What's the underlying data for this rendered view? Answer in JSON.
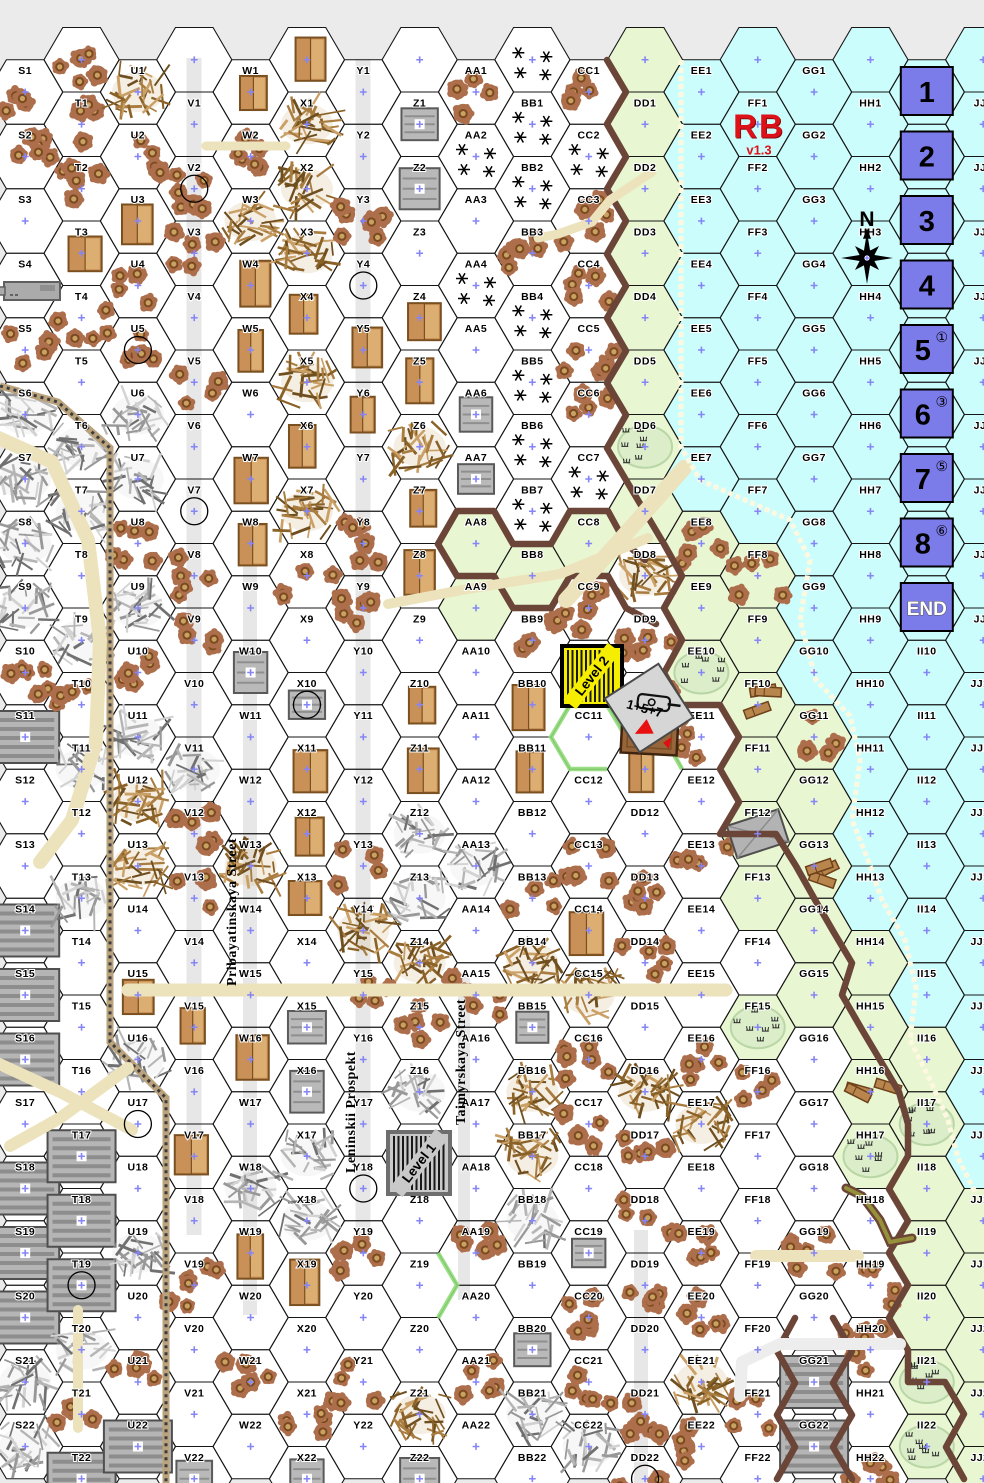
{
  "title": "RB v1.3 hex wargame map",
  "logo": {
    "line1": "RB",
    "line2": "v1.3",
    "color": "#dd1118",
    "x": 759,
    "y": 133
  },
  "compass": {
    "label": "N",
    "x": 867,
    "y": 258
  },
  "street_names": [
    {
      "text": "Pribayatinskaya Street",
      "x": 233,
      "y": 912
    },
    {
      "text": "Leninskii Prospekt",
      "x": 352,
      "y": 1112
    },
    {
      "text": "Taimyrskaya Street",
      "x": 462,
      "y": 1062
    }
  ],
  "turn_track": {
    "box_color": "#7b7bea",
    "box_border": "#000000",
    "column": "II",
    "boxes": [
      {
        "hex": "II1",
        "label": "1",
        "superscript": ""
      },
      {
        "hex": "II2",
        "label": "2",
        "superscript": ""
      },
      {
        "hex": "II3",
        "label": "3",
        "superscript": ""
      },
      {
        "hex": "II4",
        "label": "4",
        "superscript": ""
      },
      {
        "hex": "II5",
        "label": "5",
        "superscript": "①"
      },
      {
        "hex": "II6",
        "label": "6",
        "superscript": "③"
      },
      {
        "hex": "II7",
        "label": "7",
        "superscript": "⑤"
      },
      {
        "hex": "II8",
        "label": "8",
        "superscript": "⑥"
      },
      {
        "hex": "II9",
        "label": "END",
        "superscript": ""
      }
    ]
  },
  "counters": [
    {
      "id": "level2-counter",
      "label": "Level 2",
      "type": "level",
      "bg": "#f6ee00",
      "border": "#000000",
      "x": 592,
      "y": 676,
      "size": 60,
      "rot": 0,
      "text_rot": -52
    },
    {
      "id": "level1-counter",
      "label": "Level 1",
      "type": "level",
      "bg": "#c9c9c9",
      "border": "#6e6e6e",
      "x": 419,
      "y": 1163,
      "size": 62,
      "rot": 0,
      "text_rot": -52
    },
    {
      "id": "wreck-counter",
      "label": "",
      "type": "wreck",
      "bg": "#96653a",
      "border": "#3f2410",
      "x": 650,
      "y": 726,
      "size": 56,
      "rot": 3
    },
    {
      "id": "vehicle-counter-157",
      "label": "1+5+7",
      "type": "vehicle",
      "bg": "#d6d6d6",
      "border": "#4a4a4a",
      "x": 649,
      "y": 708,
      "size": 64,
      "rot": -33,
      "arrow_color": "#e81010"
    },
    {
      "id": "gun-counter-west",
      "label": "",
      "type": "gun",
      "bg": "#ababab",
      "border": "#5f5f5f",
      "x": 32,
      "y": 291,
      "size": 58,
      "rot": 0
    }
  ],
  "map": {
    "columns": [
      "S",
      "T",
      "U",
      "V",
      "W",
      "X",
      "Y",
      "Z",
      "AA",
      "BB",
      "CC",
      "DD",
      "EE",
      "FF",
      "GG",
      "HH",
      "II",
      "JJ"
    ],
    "rows": 22,
    "terrain_legend": {
      "o": "open-ground",
      "s": "shellholes",
      "r": "stone-rubble",
      "d": "wood-debris",
      "a": "scrub-stars",
      "b": "wooden-building",
      "B": "stone-building",
      "F": "factory",
      "g": "grass",
      "h": "grass-shellholes",
      "m": "marsh",
      "p": "wood-piles",
      "G": "grass-stone-building",
      "w": "water"
    },
    "terrain": {
      "S": "ssoosrrrrsFooFFFoFFFrr",
      "T": "ssbsorrorsroroooFFFrsF",
      "U": "dsbssrrsrsrddobroorosF",
      "V": "ossosoossorssobobosooB",
      "W": "bsdbbobboBoodooborboso",
      "X": "dddbdbdsoBbbboBBrrbosB",
      "Y": "oosobbossooosdsooososo",
      "Z": "BBobbdbbobbrrdsroooodB",
      "AA": "saoaoBBggooorosooososo",
      "BB": "aasaaaagsbbosdBddroBro",
      "CC": "sassssagsooosbdssoBssr",
      "DD": "gggggmgdssbossodsssoss",
      "EE": "wwwwwwwhgmsosoosdossds",
      "FF": "wwwwwwwhgpgGgomsooooso",
      "GG": "wwwwwwwwwwhgpggooosoFF",
      "HH": "wwwwwwwwwwwwwggpmossos",
      "II": "wwwwwwwwwwwwwwwgmgggmm",
      "JJ": "wwwwwwwwwwwwwwwwwggggg"
    },
    "row0": {
      "T": "s",
      "V": "o",
      "X": "b",
      "Z": "o",
      "BB": "a",
      "DD": "g",
      "FF": "w",
      "HH": "w",
      "JJ": "w"
    },
    "sewers": [
      "V2",
      "Y4",
      "U5",
      "V7",
      "X10",
      "U17",
      "Y18",
      "T19",
      "DD22"
    ]
  },
  "colors": {
    "page_bg": "#ebebeb",
    "open": "#ffffff",
    "water": "#ccfdfd",
    "grass": "#e9f6d2",
    "street": "#e7e7e7",
    "road_tan": "#ece3bd",
    "cliff": "#6b4537",
    "beach": "#fdf9e0",
    "rail_dark": "#3c3c3c",
    "rail_bed": "#b9a27c",
    "hex_line": "#161616",
    "label": "#000000",
    "center_dot": "#8585f5",
    "wood": "#c99057",
    "wood_dark": "#7a5020",
    "wood_light": "#dcae72",
    "stone": "#b9b9b9",
    "stone_dark": "#5a5a5a",
    "factory": "#b5b5b5",
    "factory_stripe": "#8d8d8d",
    "hole_outer": "#ad6e4c",
    "hole_ring": "#7b4a1e",
    "hole_center": "#c9a263",
    "marsh_fill": "#dcedc9",
    "marsh_edge": "#b9d6a6",
    "green_edge": "#8fdc78",
    "stream": "#96903a",
    "board_green": "#8fdc78"
  },
  "features": {
    "streets_v": [
      {
        "x": 194,
        "y1": 58,
        "y2": 1235,
        "w": 15
      },
      {
        "x": 363,
        "y1": 58,
        "y2": 1240,
        "w": 15
      },
      {
        "x": 250,
        "y1": 520,
        "y2": 1315,
        "w": 14
      },
      {
        "x": 464,
        "y1": 975,
        "y2": 1300,
        "w": 12
      },
      {
        "x": 641,
        "y1": 1230,
        "y2": 1483,
        "w": 14
      }
    ],
    "roads": [
      {
        "pts": [
          [
            -6,
            436
          ],
          [
            52,
            462
          ],
          [
            88,
            540
          ],
          [
            100,
            640
          ],
          [
            96,
            742
          ],
          [
            72,
            820
          ],
          [
            40,
            862
          ]
        ],
        "w": 14
      },
      {
        "pts": [
          [
            128,
            990
          ],
          [
            726,
            990
          ]
        ],
        "w": 13
      },
      {
        "pts": [
          [
            652,
            172
          ],
          [
            610,
            200
          ],
          [
            592,
            222
          ],
          [
            558,
            234
          ],
          [
            538,
            238
          ]
        ],
        "w": 9
      },
      {
        "pts": [
          [
            648,
            538
          ],
          [
            560,
            574
          ],
          [
            462,
            590
          ],
          [
            388,
            604
          ]
        ],
        "w": 10
      },
      {
        "pts": [
          [
            566,
            600
          ],
          [
            622,
            538
          ],
          [
            684,
            468
          ]
        ],
        "w": 16
      },
      {
        "pts": [
          [
            -5,
            1062
          ],
          [
            60,
            1092
          ],
          [
            132,
            1130
          ]
        ],
        "w": 12
      },
      {
        "pts": [
          [
            128,
            1068
          ],
          [
            60,
            1118
          ],
          [
            10,
            1146
          ]
        ],
        "w": 12
      },
      {
        "pts": [
          [
            756,
            1256
          ],
          [
            858,
            1256
          ]
        ],
        "w": 12
      },
      {
        "pts": [
          [
            78,
            1310
          ],
          [
            78,
            1428
          ]
        ],
        "w": 10
      },
      {
        "pts": [
          [
            206,
            146
          ],
          [
            286,
            146
          ]
        ],
        "w": 9
      }
    ],
    "light_roads": [
      {
        "pts": [
          [
            900,
            1344
          ],
          [
            780,
            1344
          ],
          [
            742,
            1362
          ],
          [
            740,
            1396
          ]
        ],
        "w": 12
      }
    ],
    "railroads": [
      {
        "pts": [
          [
            0,
            386
          ],
          [
            58,
            402
          ],
          [
            110,
            448
          ],
          [
            110,
            1042
          ],
          [
            166,
            1098
          ],
          [
            166,
            1483
          ]
        ]
      }
    ],
    "cliffs": [
      {
        "pts": [
          [
            607,
            60
          ],
          [
            626,
            92
          ],
          [
            607,
            124
          ],
          [
            626,
            157
          ],
          [
            607,
            189
          ],
          [
            626,
            221
          ],
          [
            607,
            254
          ],
          [
            626,
            286
          ],
          [
            607,
            318
          ],
          [
            626,
            351
          ],
          [
            607,
            383
          ],
          [
            626,
            415
          ],
          [
            607,
            448
          ],
          [
            626,
            480
          ],
          [
            645,
            512
          ],
          [
            664,
            544
          ],
          [
            682,
            576
          ],
          [
            664,
            608
          ],
          [
            682,
            640
          ],
          [
            664,
            673
          ],
          [
            682,
            705
          ],
          [
            720,
            705
          ],
          [
            739,
            737
          ],
          [
            720,
            769
          ],
          [
            739,
            802
          ],
          [
            720,
            834
          ],
          [
            776,
            834
          ],
          [
            796,
            866
          ],
          [
            814,
            898
          ],
          [
            833,
            931
          ],
          [
            852,
            963
          ],
          [
            842,
            995
          ],
          [
            861,
            1028
          ],
          [
            880,
            1060
          ],
          [
            899,
            1092
          ],
          [
            908,
            1124
          ],
          [
            908,
            1156
          ],
          [
            889,
            1189
          ],
          [
            908,
            1221
          ],
          [
            889,
            1253
          ],
          [
            908,
            1285
          ],
          [
            889,
            1318
          ],
          [
            908,
            1350
          ],
          [
            908,
            1382
          ],
          [
            945,
            1382
          ],
          [
            964,
            1414
          ],
          [
            946,
            1447
          ],
          [
            964,
            1479
          ]
        ]
      },
      {
        "pts": [
          [
            438,
            544
          ],
          [
            457,
            511
          ],
          [
            494,
            511
          ],
          [
            513,
            544
          ],
          [
            551,
            544
          ],
          [
            570,
            511
          ],
          [
            608,
            511
          ],
          [
            626,
            544
          ],
          [
            645,
            560
          ]
        ]
      },
      {
        "pts": [
          [
            438,
            544
          ],
          [
            457,
            576
          ],
          [
            494,
            576
          ],
          [
            513,
            608
          ],
          [
            551,
            608
          ],
          [
            570,
            576
          ],
          [
            608,
            576
          ],
          [
            626,
            608
          ],
          [
            656,
            624
          ]
        ]
      },
      {
        "pts": [
          [
            795,
            1318
          ],
          [
            777,
            1351
          ],
          [
            795,
            1383
          ],
          [
            777,
            1415
          ],
          [
            795,
            1447
          ],
          [
            777,
            1479
          ]
        ]
      },
      {
        "pts": [
          [
            833,
            1318
          ],
          [
            852,
            1351
          ],
          [
            833,
            1383
          ],
          [
            852,
            1415
          ],
          [
            833,
            1447
          ],
          [
            852,
            1479
          ]
        ]
      }
    ],
    "beach": [
      {
        "pts": [
          [
            681,
            60
          ],
          [
            681,
            447
          ],
          [
            700,
            480
          ],
          [
            745,
            500
          ],
          [
            790,
            520
          ],
          [
            810,
            560
          ],
          [
            800,
            620
          ],
          [
            816,
            680
          ],
          [
            850,
            716
          ],
          [
            860,
            760
          ],
          [
            852,
            820
          ],
          [
            868,
            860
          ],
          [
            882,
            900
          ],
          [
            905,
            940
          ],
          [
            916,
            988
          ],
          [
            910,
            1040
          ],
          [
            930,
            1080
          ],
          [
            948,
            1120
          ],
          [
            958,
            1158
          ],
          [
            975,
            1192
          ]
        ]
      }
    ],
    "streams": [
      {
        "pts": [
          [
            846,
            1188
          ],
          [
            862,
            1196
          ],
          [
            880,
            1220
          ],
          [
            890,
            1242
          ],
          [
            912,
            1238
          ]
        ]
      }
    ],
    "green_hexsides": [
      {
        "pts": [
          [
            626,
            737
          ],
          [
            607,
            705
          ],
          [
            570,
            705
          ],
          [
            551,
            737
          ],
          [
            570,
            769
          ],
          [
            607,
            769
          ]
        ]
      },
      {
        "pts": [
          [
            438,
            1253
          ],
          [
            457,
            1285
          ],
          [
            438,
            1318
          ]
        ]
      },
      {
        "pts": [
          [
            682,
            705
          ],
          [
            664,
            737
          ],
          [
            682,
            769
          ]
        ]
      }
    ]
  }
}
